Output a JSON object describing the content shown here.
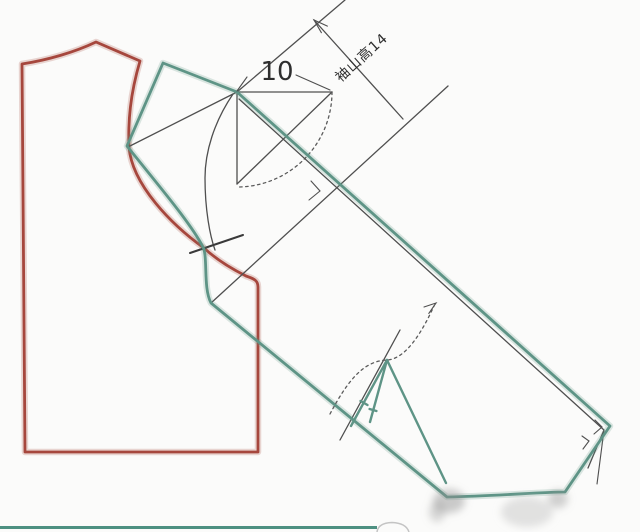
{
  "labels": {
    "shoulder_extension": "10",
    "sleeve_cap_height": "袖山高14"
  },
  "colors": {
    "bodice": "#a6473d",
    "sleeve": "#5e9486",
    "construction": "#4f4f4f",
    "dotted": "#5a5a5a",
    "notch": "#3a3a3a",
    "label": "#2e2e2e",
    "baseline": "#4d9081",
    "tab": "#c4c4c4",
    "smudge_dark": "#8f8f8f",
    "smudge_light": "#c7c7c7"
  }
}
